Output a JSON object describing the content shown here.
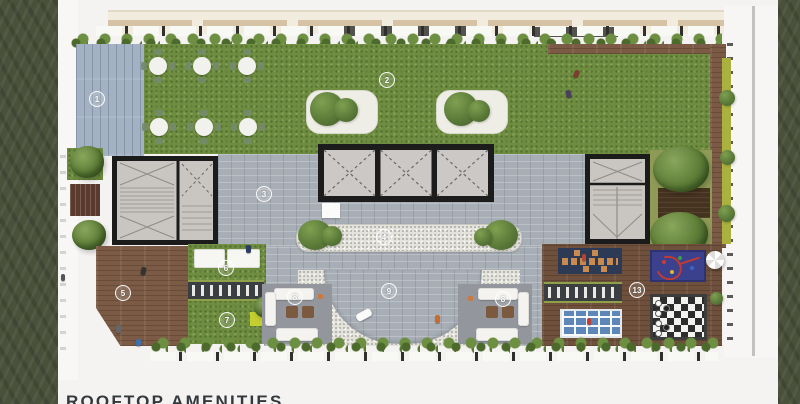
{
  "page": {
    "title": "ROOFTOP AMENITIES"
  },
  "plan": {
    "type": "rooftop-amenities-floor-plan",
    "markers": [
      {
        "label": "1",
        "area": "blue-timber-sun-deck"
      },
      {
        "label": "2",
        "area": "rooftop-lawn"
      },
      {
        "label": "3",
        "area": "paved-terrace"
      },
      {
        "label": "4",
        "area": "pebble-water-feature"
      },
      {
        "label": "5",
        "area": "timber-deck"
      },
      {
        "label": "6",
        "area": "day-beds"
      },
      {
        "label": "7",
        "area": "lawn-patch"
      },
      {
        "label": "8",
        "area": "lounge-seating-left"
      },
      {
        "label": "8",
        "area": "lounge-seating-right"
      },
      {
        "label": "9",
        "area": "pebble-court"
      },
      {
        "label": "13",
        "area": "games-deck"
      }
    ],
    "colors": {
      "page_bg": "#f4f3f1",
      "side_band_green": "#49513b",
      "lawn_green": "#6e8d40",
      "timber_deck": "#7b5b45",
      "blue_deck": "#a3b1c3",
      "pavers_grey": "#a8aeb6",
      "pebble_white": "#e4e3dc",
      "core_fill": "#c9c6c2",
      "core_outline": "#1b1b1b",
      "hedge_green": "#5c7c34",
      "slab_beige": "#f2ecdf",
      "hopscotch_mat": "#2d3a56",
      "kids_mat_blue": "#3b418d",
      "game_grid_blue": "#5d87b8",
      "chess_dark": "#2d2d2d",
      "title_text": "#33383c"
    }
  }
}
